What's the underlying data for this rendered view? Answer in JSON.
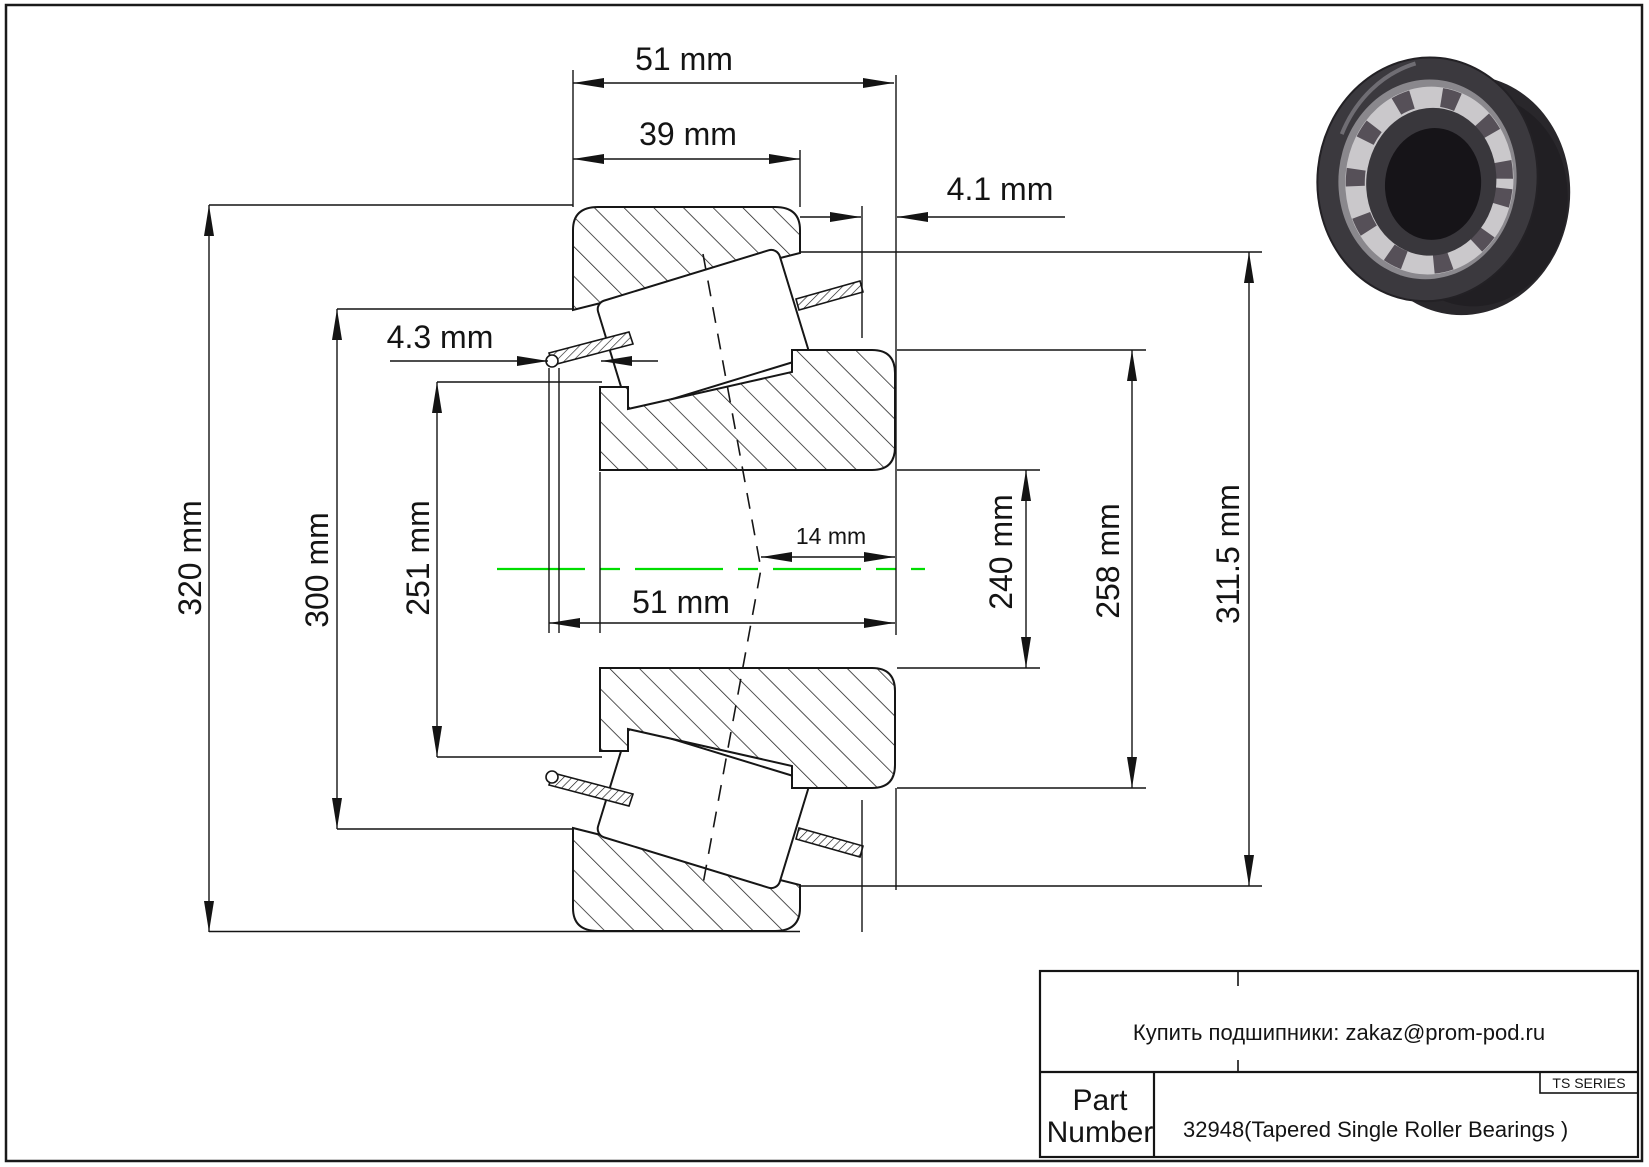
{
  "drawing": {
    "dims": {
      "total_width_top": "51 mm",
      "cup_width": "39 mm",
      "protrusion_right": "4.1 mm",
      "protrusion_left": "4.3 mm",
      "outer_diameter": "320 mm",
      "cup_front_diameter": "300 mm",
      "cone_front_diameter": "251 mm",
      "bore_diameter": "240 mm",
      "cone_back_diameter": "258 mm",
      "fit_diameter": "311.5 mm",
      "cone_width_bottom": "51 mm",
      "roller_axis_offset": "14 mm"
    },
    "centerline_color": "#00dd00",
    "line_color": "#161616"
  },
  "title_block": {
    "contact": "Купить подшипники: zakaz@prom-pod.ru",
    "series": "TS SERIES",
    "part_label_line1": "Part",
    "part_label_line2": "Number",
    "part_value": "32948(Tapered Single Roller Bearings )"
  }
}
